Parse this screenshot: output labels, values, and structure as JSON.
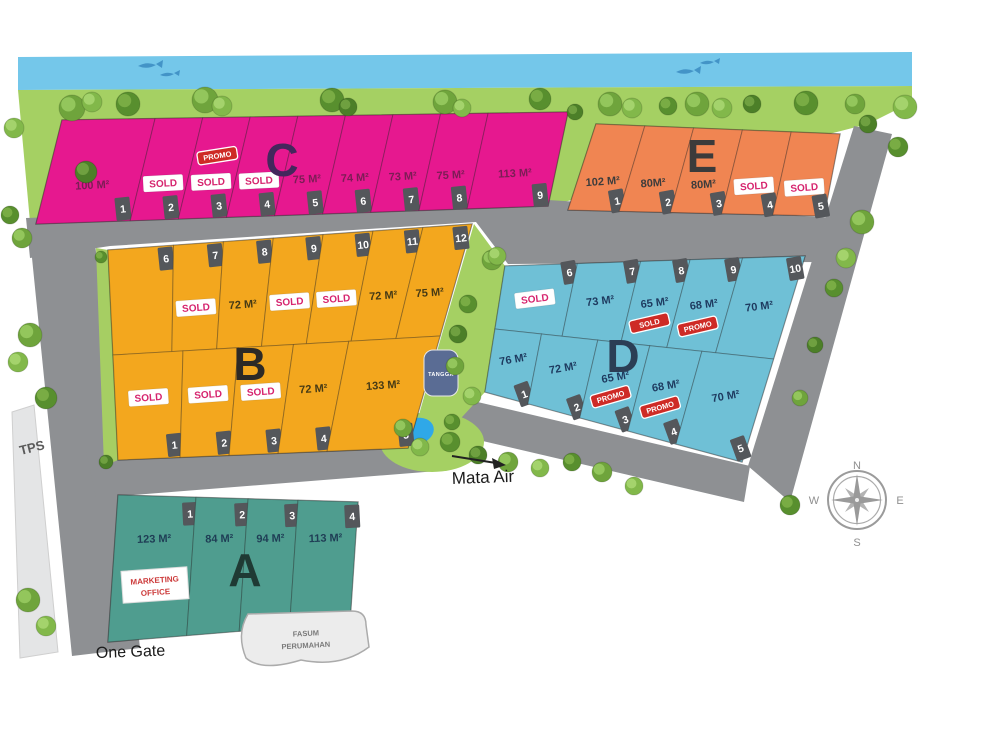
{
  "legend": {
    "one_gate": "One Gate",
    "mata_air": "Mata Air",
    "tps": "TPS",
    "fasum_line1": "FASUM",
    "fasum_line2": "PERUMAHAN",
    "tangga": "TANGGA"
  },
  "compass": {
    "n": "N",
    "e": "E",
    "s": "S",
    "w": "W"
  },
  "badges": {
    "sold": "SOLD",
    "promo": "PROMO",
    "marketing_line1": "MARKETING",
    "marketing_line2": "OFFICE"
  },
  "colors": {
    "river": "#74C7EA",
    "grass": "#A5D063",
    "grass_strip": "#A6CE63",
    "road": "#8E9093",
    "tps_area": "#E4E5E6",
    "block_c": "#E6188F",
    "block_e": "#F08552",
    "block_b": "#F3A71E",
    "block_d": "#6FC0D6",
    "block_a": "#4F9D8F",
    "tag": "#54575B",
    "sold_text": "#D6246E",
    "badge_red": "#CE2B26",
    "pond": "#2FA8E8",
    "tangga_badge": "#5A6C94",
    "compass": "#9B9B9B"
  },
  "blocks": [
    {
      "id": "C",
      "letter": "C",
      "color": "#E6188F",
      "letter_color": "#44275C",
      "label_color": "#7B1D55",
      "rows": [
        {
          "lots": [
            {
              "no": "1",
              "area": "100 M²"
            },
            {
              "no": "2",
              "sold": true
            },
            {
              "no": "3",
              "sold": true,
              "promo_red": true,
              "promo_pos": "above"
            },
            {
              "no": "4",
              "sold": true
            },
            {
              "no": "5",
              "area": "75 M²"
            },
            {
              "no": "6",
              "area": "74 M²"
            },
            {
              "no": "7",
              "area": "73 M²"
            },
            {
              "no": "8",
              "area": "75 M²"
            },
            {
              "no": "9",
              "area": "113 M²"
            }
          ]
        }
      ]
    },
    {
      "id": "E",
      "letter": "E",
      "color": "#F08552",
      "letter_color": "#3B3B3B",
      "label_color": "#3C3C3C",
      "rows": [
        {
          "lots": [
            {
              "no": "1",
              "area": "102 M²"
            },
            {
              "no": "2",
              "area": "80M²"
            },
            {
              "no": "3",
              "area": "80M²"
            },
            {
              "no": "4",
              "sold": true
            },
            {
              "no": "5",
              "sold": true
            }
          ]
        }
      ]
    },
    {
      "id": "B",
      "letter": "B",
      "color": "#F3A71E",
      "letter_color": "#2D2A26",
      "label_color": "#463A15",
      "rows": [
        {
          "lots": [
            {
              "no": "6"
            },
            {
              "no": "7",
              "sold": true
            },
            {
              "no": "8",
              "area": "72 M²"
            },
            {
              "no": "9",
              "sold": true
            },
            {
              "no": "10",
              "sold": true
            },
            {
              "no": "11",
              "area": "72 M²"
            },
            {
              "no": "12",
              "area": "75 M²"
            }
          ]
        },
        {
          "lots": [
            {
              "no": "1",
              "sold": true
            },
            {
              "no": "2",
              "sold": true
            },
            {
              "no": "3",
              "sold": true
            },
            {
              "no": "4",
              "area": "72 M²"
            },
            {
              "no": "5",
              "area": "133 M²"
            }
          ]
        }
      ]
    },
    {
      "id": "D",
      "letter": "D",
      "color": "#6FC0D6",
      "letter_color": "#2B3E55",
      "label_color": "#1E3A5F",
      "rows": [
        {
          "lots": [
            {
              "no": "6",
              "sold": true
            },
            {
              "no": "7",
              "area": "73 M²"
            },
            {
              "no": "8",
              "area": "65 M²",
              "sold_red": true
            },
            {
              "no": "9",
              "area": "68 M²",
              "promo_red": true
            },
            {
              "no": "10",
              "area": "70 M²"
            }
          ]
        },
        {
          "lots": [
            {
              "no": "1",
              "area": "76 M²"
            },
            {
              "no": "2",
              "area": "72 M²"
            },
            {
              "no": "3",
              "area": "65 M²",
              "promo_red": true
            },
            {
              "no": "4",
              "area": "68 M²",
              "promo_red": true
            },
            {
              "no": "5",
              "area": "70 M²"
            }
          ]
        }
      ]
    },
    {
      "id": "A",
      "letter": "A",
      "color": "#4F9D8F",
      "letter_color": "#1F3A34",
      "label_color": "#1F3D55",
      "rows": [
        {
          "lots": [
            {
              "no": "1",
              "area": "123 M²"
            },
            {
              "no": "2",
              "area": "84 M²"
            },
            {
              "no": "3",
              "area": "94 M²"
            },
            {
              "no": "4",
              "area": "113 M²"
            }
          ]
        }
      ]
    }
  ]
}
